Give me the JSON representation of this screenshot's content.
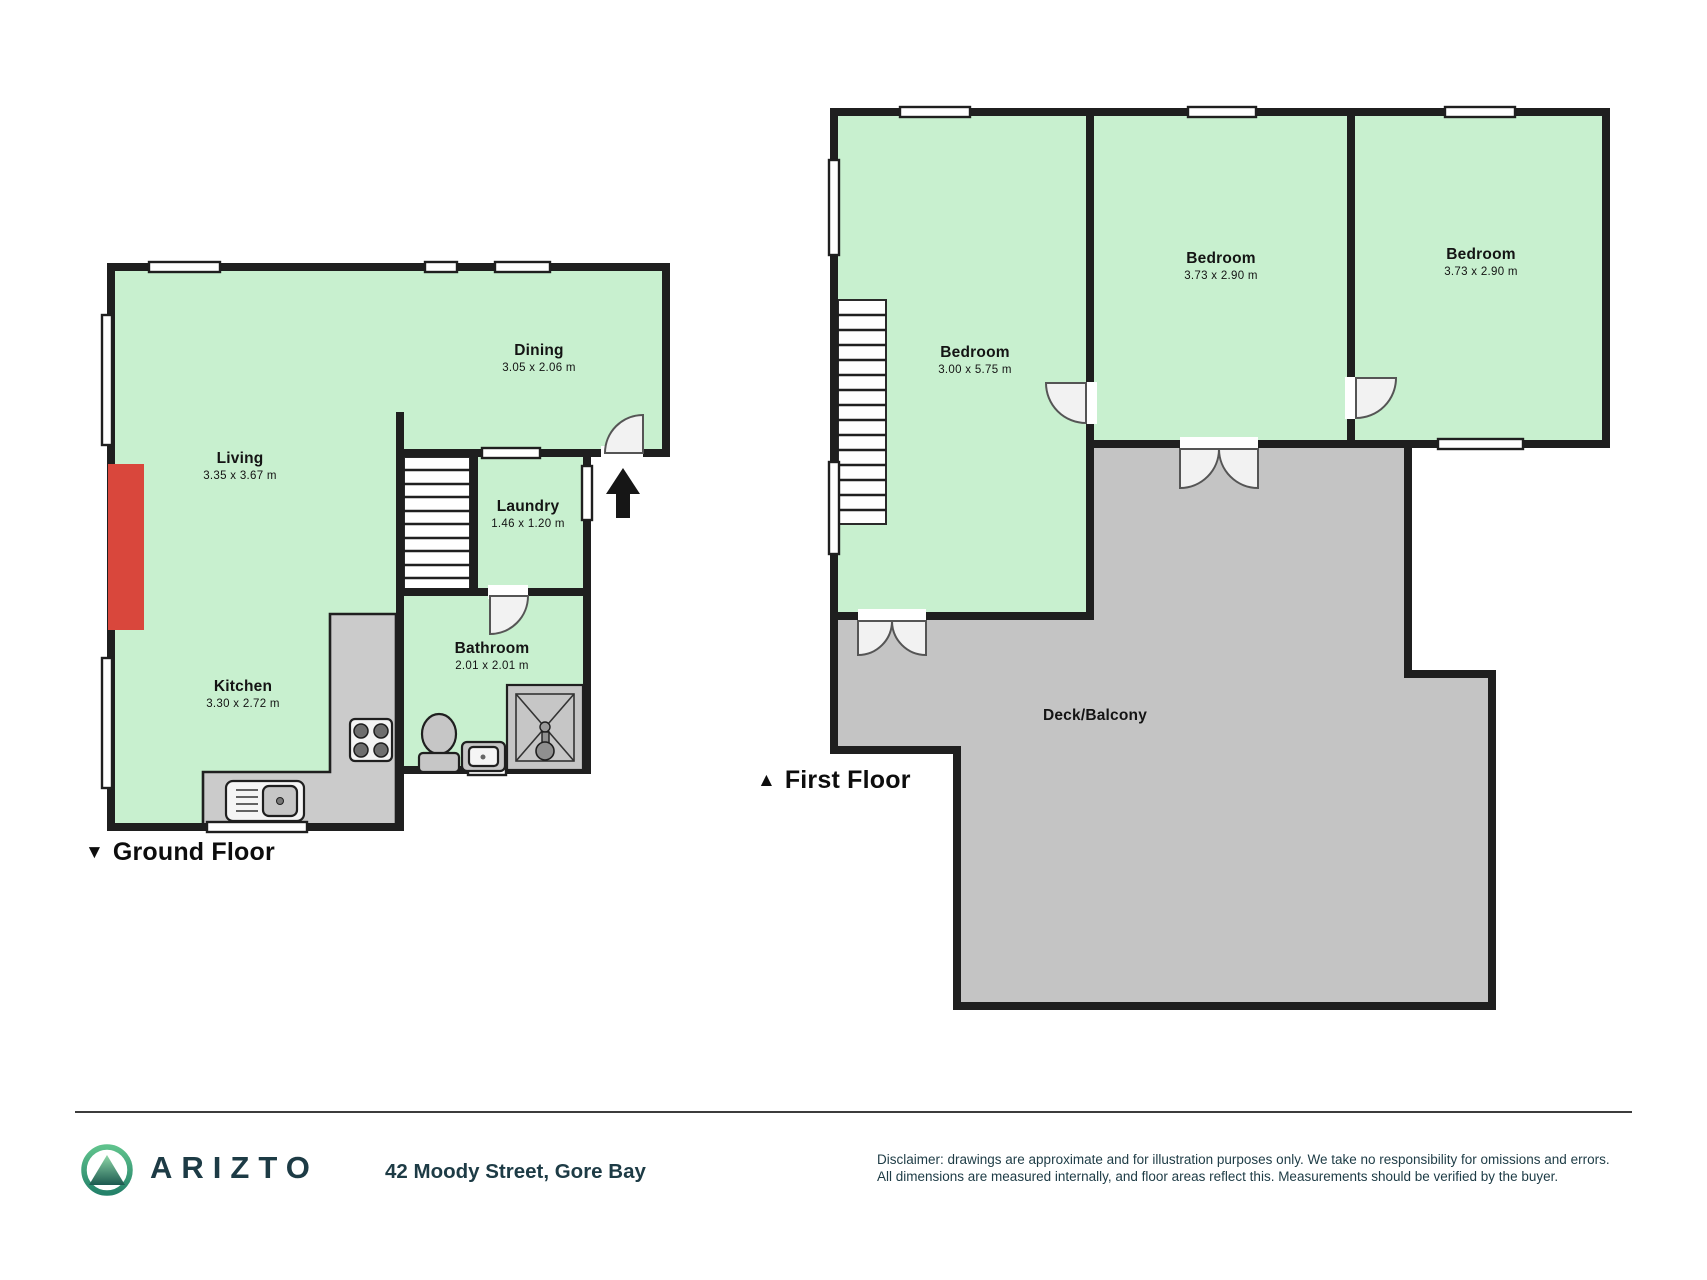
{
  "floors": {
    "ground": {
      "marker": "▼",
      "label": "Ground Floor",
      "rooms": {
        "living": {
          "name": "Living",
          "dims": "3.35 x 3.67 m"
        },
        "dining": {
          "name": "Dining",
          "dims": "3.05 x 2.06 m"
        },
        "laundry": {
          "name": "Laundry",
          "dims": "1.46 x 1.20 m"
        },
        "bathroom": {
          "name": "Bathroom",
          "dims": "2.01 x 2.01 m"
        },
        "kitchen": {
          "name": "Kitchen",
          "dims": "3.30 x 2.72 m"
        }
      }
    },
    "first": {
      "marker": "▲",
      "label": "First Floor",
      "rooms": {
        "bedroom1": {
          "name": "Bedroom",
          "dims": "3.00 x 5.75 m"
        },
        "bedroom2": {
          "name": "Bedroom",
          "dims": "3.73 x 2.90 m"
        },
        "bedroom3": {
          "name": "Bedroom",
          "dims": "3.73 x 2.90 m"
        },
        "deck": {
          "name": "Deck/Balcony"
        }
      }
    }
  },
  "footer": {
    "brand": "ARIZTO",
    "address": "42 Moody Street, Gore Bay",
    "disclaimer_line1": "Disclaimer: drawings are approximate and for illustration purposes only. We take no responsibility for omissions and errors.",
    "disclaimer_line2": "All dimensions are measured internally, and floor areas reflect this. Measurements should be verified by the buyer."
  },
  "colors": {
    "room_fill": "#c8f0cf",
    "deck_fill": "#c4c4c4",
    "wall": "#1f1f1f",
    "accent_red": "#d9473c",
    "brand_navy": "#1d3b45",
    "logo_green_light": "#7fd19e",
    "logo_green_dark": "#1d5a50"
  }
}
